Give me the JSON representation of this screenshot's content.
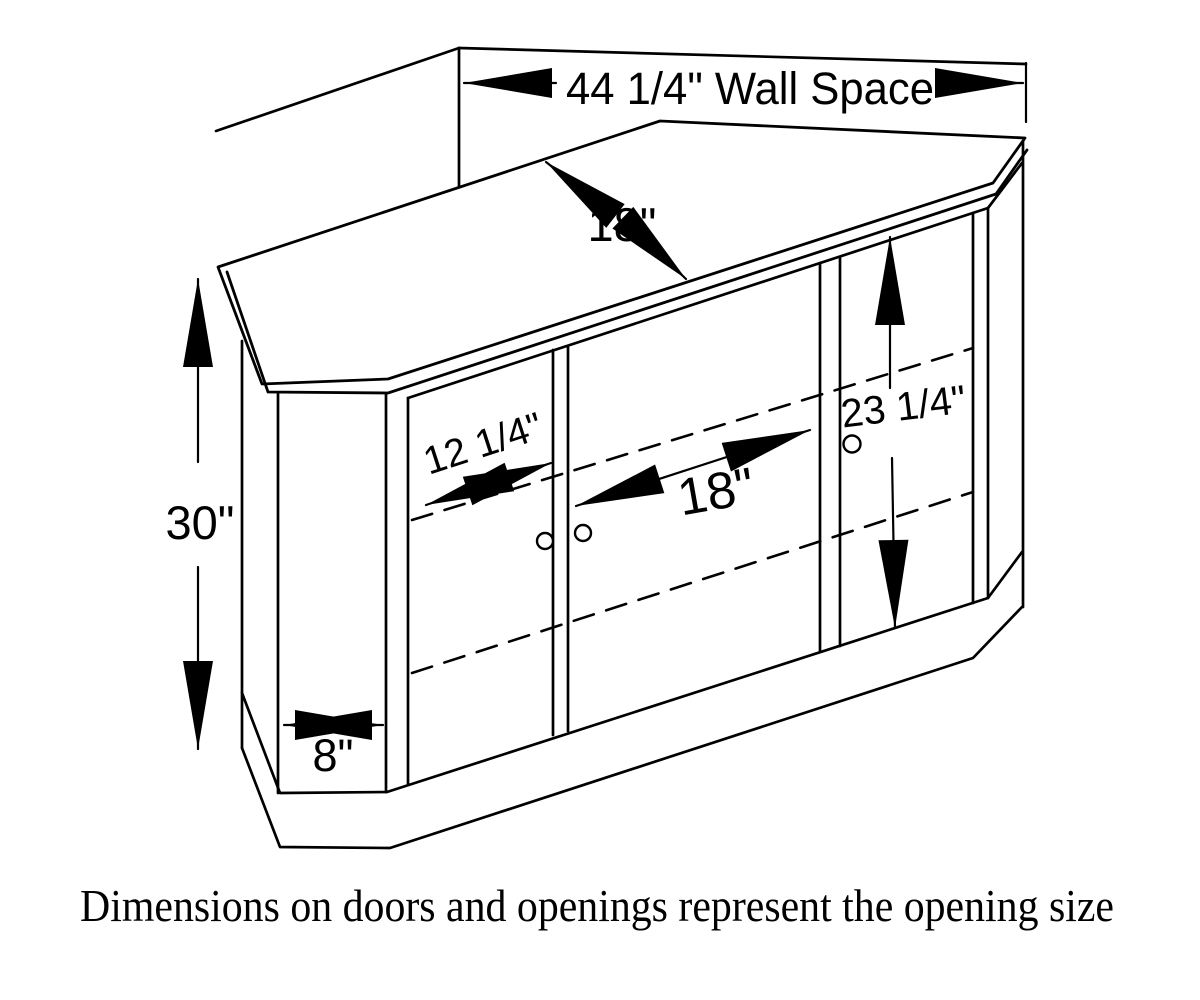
{
  "drawing": {
    "type": "furniture-dimension-diagram",
    "subject": "corner TV cabinet with three doors",
    "caption": "Dimensions on doors and openings represent the opening size",
    "dimensions": {
      "wall_space": "44 1/4\" Wall Space",
      "top_depth": "18\"",
      "overall_height": "30\"",
      "left_door_opening": "12 1/4\"",
      "center_opening": "18\"",
      "opening_height": "23 1/4\"",
      "side_panel_width": "8\""
    },
    "colors": {
      "line": "#000000",
      "background": "#ffffff"
    }
  }
}
